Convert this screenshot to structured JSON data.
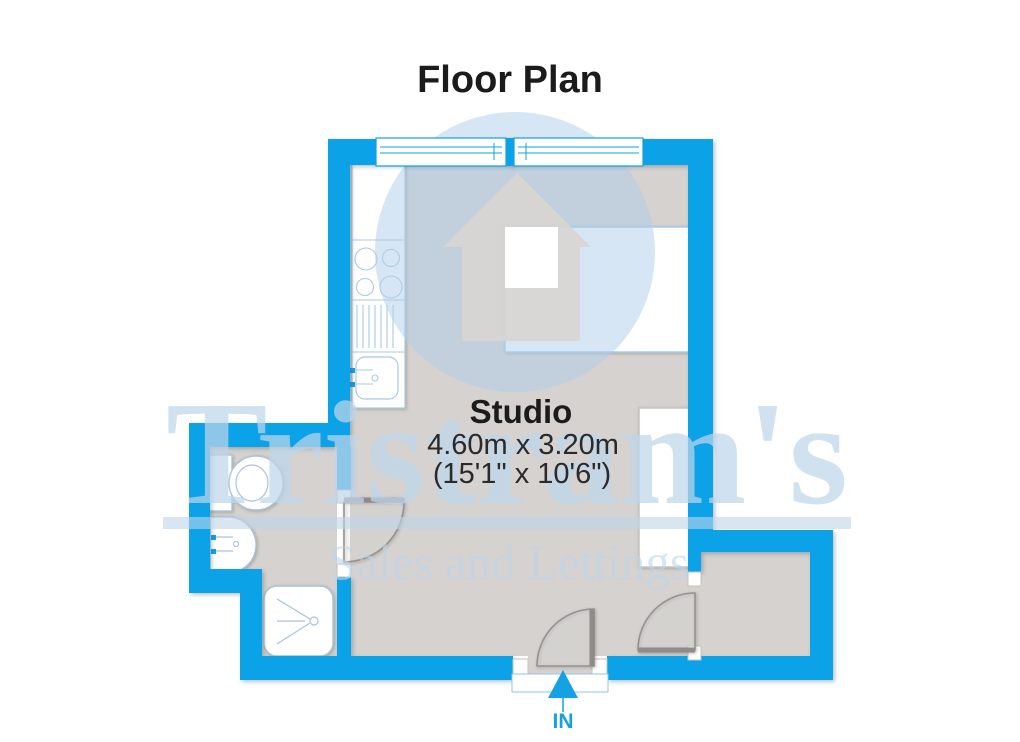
{
  "title": "Floor Plan",
  "room": {
    "name": "Studio",
    "dimensions_metric": "4.60m x 3.20m",
    "dimensions_imperial": "(15'1\" x 10'6\")"
  },
  "entrance": {
    "label": "IN"
  },
  "watermark": {
    "brand": "Tristram's",
    "tagline": "Sales and Lettings"
  },
  "colors": {
    "wall": "#0ca2e8",
    "floor": "#d5d2cf",
    "accent": "#16a1e3",
    "fixture-stroke": "#a9c4d6",
    "kitchen-stroke": "#a9cbdf",
    "door-stroke": "#97928e",
    "text": "#1b1b1b",
    "watermark-blue": "#bed5ea",
    "logo-circle": "#afcdeb",
    "logo-house": "#d8d5d2"
  }
}
